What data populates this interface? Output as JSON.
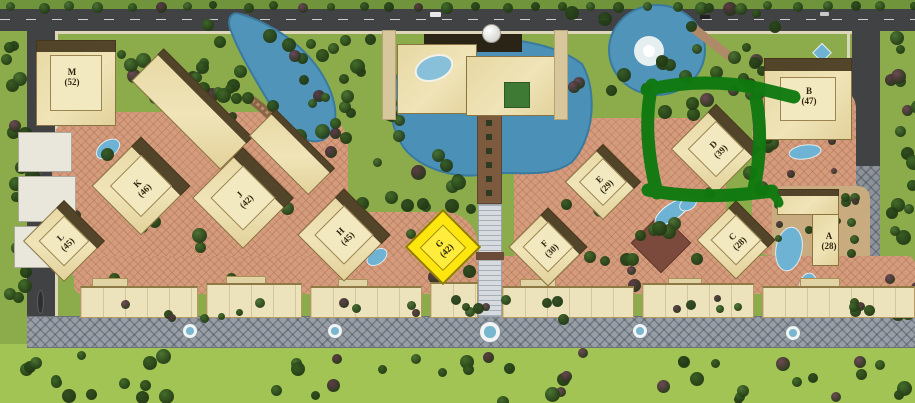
{
  "map": {
    "type": "residential-site-plan",
    "buildings": [
      {
        "name": "M",
        "count": "(52)"
      },
      {
        "name": "L",
        "count": "(45)"
      },
      {
        "name": "K",
        "count": "(46)"
      },
      {
        "name": "J",
        "count": "(42)"
      },
      {
        "name": "H",
        "count": "(45)"
      },
      {
        "name": "G",
        "count": "(42)"
      },
      {
        "name": "F",
        "count": "(30)"
      },
      {
        "name": "E",
        "count": "(29)"
      },
      {
        "name": "D",
        "count": "(39)"
      },
      {
        "name": "C",
        "count": "(28)"
      },
      {
        "name": "B",
        "count": "(47)"
      },
      {
        "name": "A",
        "count": "(28)"
      }
    ],
    "highlight": {
      "building": "G",
      "fill": "#ffe60e"
    },
    "annotation": {
      "shape": "hand-drawn-rectangle",
      "around": "D",
      "color": "#0f790f"
    },
    "colors": {
      "lawn": "#8cab4b",
      "lawn_bottom": "#a2c455",
      "water": "#5094b9",
      "building": "#ecdfae",
      "road": "#414244",
      "paving": "#d49b7d",
      "promenade": "#989ea6"
    }
  }
}
